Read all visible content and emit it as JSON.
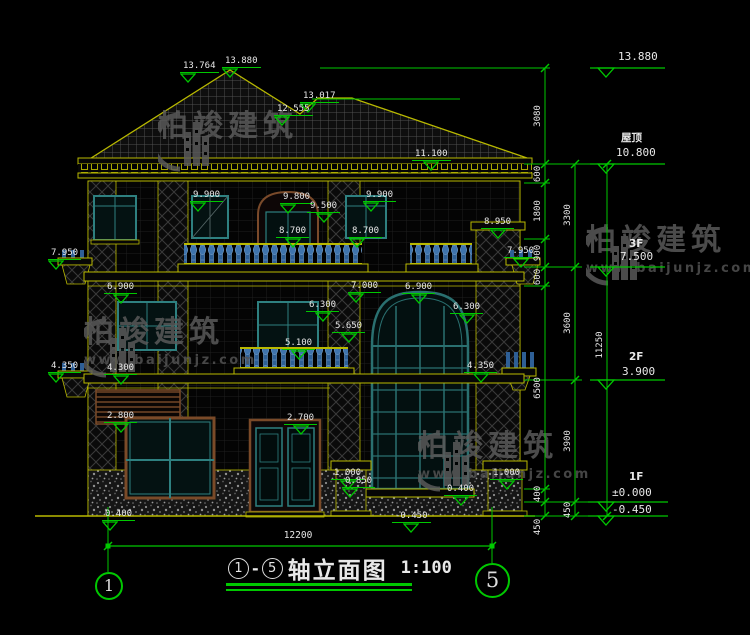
{
  "drawing": {
    "title": {
      "axis_start": "1",
      "axis_end": "5",
      "dash": "-",
      "name": "轴立面图",
      "scale": "1:100"
    },
    "axis_bubbles": [
      {
        "label": "1"
      },
      {
        "label": "5"
      }
    ],
    "watermark": {
      "name": "柏竣建筑",
      "url": "www.baijunjz.com"
    },
    "bottom_dim": "12200",
    "colors": {
      "annotation": "#00c800",
      "outline": "#b9b900",
      "text": "#e8e8e8",
      "frame_teal": "#2e8080",
      "frame_brown": "#7a4a28",
      "baluster_blue": "#2e5f96"
    },
    "right_levels": [
      {
        "name": "",
        "value": "13.880",
        "nx": 0,
        "ny": 0,
        "vx": 618,
        "vy": 50
      },
      {
        "name": "屋顶",
        "value": "10.800",
        "nx": 621,
        "ny": 130,
        "vx": 616,
        "vy": 146
      },
      {
        "name": "3F",
        "value": "7.500",
        "nx": 629,
        "ny": 238,
        "vx": 620,
        "vy": 250
      },
      {
        "name": "2F",
        "value": "3.900",
        "nx": 629,
        "ny": 351,
        "vx": 622,
        "vy": 365
      },
      {
        "name": "1F",
        "value": "±0.000",
        "nx": 629,
        "ny": 471,
        "vx": 612,
        "vy": 486
      },
      {
        "name": "",
        "value": "-0.450",
        "nx": 0,
        "ny": 0,
        "vx": 612,
        "vy": 503
      }
    ],
    "elevation_markers": [
      {
        "v": "13.764",
        "x": 180,
        "y": 53,
        "tri": "right"
      },
      {
        "v": "13.880",
        "x": 222,
        "y": 48,
        "tri": "left"
      },
      {
        "v": "13.017",
        "x": 300,
        "y": 83,
        "tri": "left"
      },
      {
        "v": "12.555",
        "x": 274,
        "y": 96,
        "tri": "right"
      },
      {
        "v": "11.100",
        "x": 412,
        "y": 141,
        "tri": "center"
      },
      {
        "v": "9.900",
        "x": 190,
        "y": 182,
        "tri": "left"
      },
      {
        "v": "9.800",
        "x": 280,
        "y": 184,
        "tri": "left"
      },
      {
        "v": "9.500",
        "x": 307,
        "y": 193,
        "tri": "center"
      },
      {
        "v": "8.700",
        "x": 276,
        "y": 218,
        "tri": "center"
      },
      {
        "v": "9.900",
        "x": 363,
        "y": 182,
        "tri": "left"
      },
      {
        "v": "8.700",
        "x": 349,
        "y": 218,
        "tri": "left"
      },
      {
        "v": "8.950",
        "x": 481,
        "y": 209,
        "tri": "center"
      },
      {
        "v": "7.950",
        "x": 48,
        "y": 240,
        "tri": "right"
      },
      {
        "v": "7.950",
        "x": 504,
        "y": 238,
        "tri": "center"
      },
      {
        "v": "7.000",
        "x": 348,
        "y": 273,
        "tri": "left"
      },
      {
        "v": "6.900",
        "x": 104,
        "y": 274,
        "tri": "center"
      },
      {
        "v": "6.900",
        "x": 402,
        "y": 274,
        "tri": "center"
      },
      {
        "v": "6.300",
        "x": 306,
        "y": 292,
        "tri": "center"
      },
      {
        "v": "5.650",
        "x": 332,
        "y": 313,
        "tri": "center"
      },
      {
        "v": "5.100",
        "x": 282,
        "y": 330,
        "tri": "center"
      },
      {
        "v": "6.300",
        "x": 450,
        "y": 294,
        "tri": "center"
      },
      {
        "v": "4.350",
        "x": 48,
        "y": 353,
        "tri": "right"
      },
      {
        "v": "4.300",
        "x": 104,
        "y": 355,
        "tri": "center"
      },
      {
        "v": "4.350",
        "x": 464,
        "y": 353,
        "tri": "center"
      },
      {
        "v": "2.800",
        "x": 104,
        "y": 403,
        "tri": "center"
      },
      {
        "v": "2.700",
        "x": 284,
        "y": 405,
        "tri": "center"
      },
      {
        "v": "1.000",
        "x": 331,
        "y": 460,
        "tri": "center"
      },
      {
        "v": "0.850",
        "x": 342,
        "y": 468,
        "tri": "left"
      },
      {
        "v": "1.000",
        "x": 490,
        "y": 460,
        "tri": "center"
      },
      {
        "v": "0.400",
        "x": 444,
        "y": 476,
        "tri": "center"
      },
      {
        "v": "0.400",
        "x": 102,
        "y": 501,
        "tri": "right"
      },
      {
        "v": "-0.450",
        "x": 392,
        "y": 503,
        "tri": "center"
      }
    ],
    "dim_chains": [
      {
        "x": 545,
        "labels": [
          {
            "v": "3080",
            "y": 116
          },
          {
            "v": "600",
            "y": 174
          },
          {
            "v": "1800",
            "y": 211
          },
          {
            "v": "900",
            "y": 253
          },
          {
            "v": "600",
            "y": 277
          },
          {
            "v": "6500",
            "y": 388
          },
          {
            "v": "400",
            "y": 494
          },
          {
            "v": "450",
            "y": 527
          }
        ]
      },
      {
        "x": 575,
        "labels": [
          {
            "v": "3300",
            "y": 215
          },
          {
            "v": "3600",
            "y": 323
          },
          {
            "v": "3900",
            "y": 441
          },
          {
            "v": "450",
            "y": 510
          }
        ]
      },
      {
        "x": 607,
        "labels": [
          {
            "v": "11250",
            "y": 345
          }
        ]
      }
    ]
  }
}
